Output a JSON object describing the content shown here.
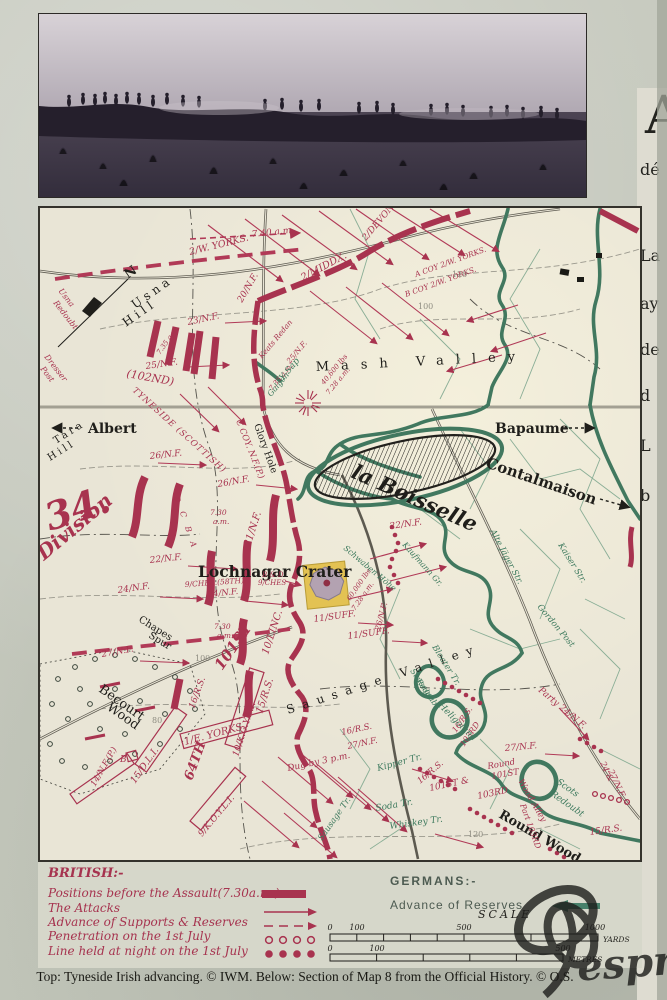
{
  "panel": {
    "caption": "Top: Tyneside Irish advancing. © IWM. Below: Section of Map 8 from the Official History. © O.S.",
    "watermark": "esprez"
  },
  "side_column": {
    "dropcap": "A",
    "line1": "dé",
    "line2": "La",
    "line3": "ay",
    "line4": "de",
    "line5": "d",
    "line6": "L",
    "line7": "b"
  },
  "colors": {
    "map_red": "#a8334f",
    "map_green": "#3e7a5e",
    "paper": "#e9e5d6",
    "panel": "#c6c9bf"
  },
  "map": {
    "labels": {
      "t740": "7.40 a.m.",
      "wyorks2": "2/W. YORKS.",
      "middx": "2/MIDDX.",
      "devon": "2/DEVON",
      "nf20": "20/N.F.",
      "acoy": "A COY 2/W. YORKS.",
      "bcoy": "B COY 2/W. YORKS.",
      "nf23": "23/N.F.",
      "nf25": "25/N.F.",
      "t735a": "7.35 a.m.",
      "d102": "(102ND)",
      "tyneside": "TYNESIDE (SCOTTISH)",
      "keats": "Keats Redan",
      "nf25b": "25/N.F.",
      "t735b": "7.35 a.m.",
      "mine1a": "40,600 lbs",
      "mine1b": "7.28 a.m.",
      "usna_redoubt1": "Usna",
      "usna_redoubt2": "Redoubt",
      "dresser1": "Dresser",
      "dresser2": "Post",
      "usna1": "Usna",
      "usna2": "Hill",
      "tara1": "Tara",
      "tara2": "Hill",
      "north": "N",
      "mash": "Mash Valley",
      "albert": "Albert",
      "bapaume": "Bapaume",
      "contalmaison": "Contalmaison",
      "la_boisselle": "la Boisselle",
      "glory": "Glory Hole",
      "ccoy": "C COY. N.F.(P.)",
      "div34": "34.",
      "division": "Division",
      "nf26a": "26/N.F.",
      "nf26b": "26/N.F.",
      "nf26c": "26/N.F.",
      "nf21": "21/N.F.",
      "compD": "D",
      "compC": "C",
      "compB": "B",
      "compA": "A",
      "t730a1": "7.30",
      "t730a2": "a.m.",
      "t730b1": "7.30",
      "t730b2": "a.m.",
      "nf22a": "22/N.F.",
      "nf22b": "22/N.F.",
      "nf24a": "24/N.F.",
      "nf24b": "24/N.F.",
      "ches9": "9/CHES.(58TH)",
      "bd1": "B & D",
      "bd2": "9/CHES",
      "lochnagar": "Lochnagar Crater",
      "suff11a": "11/SUFF.",
      "suff11b": "11/SUFF.",
      "mine2a": "60,000 lbs",
      "mine2b": "7.28 a.m.",
      "lincs": "10/LINC.",
      "st101": "101ST",
      "rs15a": "15/R.S.",
      "rs15b": "15/R.S.",
      "rs16a": "16/R.S.",
      "rs16b": "16/R.S.",
      "rs16c": "16/R.S.",
      "rs16d": "16/R.S.",
      "rd103a": "103RD",
      "st101amp": "101ST &",
      "rd103b": "103RD",
      "round1": "Round",
      "round2": "101ST",
      "part103": "Part 103RD",
      "woodalley": "Wood Alley",
      "party24": "Party 24/N.F.",
      "n2427a": "24 &",
      "n2427b": "27/N.F.",
      "nf27a": "27/N.F.",
      "nf27b": "27/N.F.",
      "nf27c": "27/N.F.",
      "eyorks": "1/E. YORKS.",
      "dli15": "15/D.L.I.",
      "bco": "B.",
      "nf14": "14/N.F.(P.)",
      "th64": "64TH",
      "koyli9": "9/K.O.Y.L.I.",
      "koyli10": "10/K.O.Y.L.I.",
      "dug3": "Dug by 3 p.m.",
      "sausage_valley": "Sausage Valley",
      "chapes1": "Chapes",
      "chapes2": "Spur",
      "becourt1": "Becourt",
      "becourt2": "Wood",
      "round_wood": "Round Wood",
      "ysap": "Y Sap",
      "galgen": "Galgen",
      "schwaben": "Schwaben Höhe",
      "kaufmann": "Kaufmann Gr.",
      "altejager": "Alte Jäger Str.",
      "kaiser": "Kaiser Str.",
      "gordon": "Gordon Post",
      "bloater": "Bloater Tr.",
      "sausred1": "Sausage",
      "sausred2": "Redoubt",
      "heligoland": "Heligoland",
      "kipper": "Kipper Tr.",
      "soda": "Soda Tr.",
      "whiskey": "Whiskey Tr.",
      "sausagetr": "Sausage Tr.",
      "scots1": "Scots",
      "scots2": "Redoubt",
      "c120a": "120",
      "c100a": "100",
      "c100b": "100",
      "c80": "80",
      "c120b": "120"
    }
  },
  "legend": {
    "british_title": "BRITISH:-",
    "items": [
      {
        "label": "Positions before the Assault(7.30a.m.)"
      },
      {
        "label": "The Attacks"
      },
      {
        "label": "Advance of Supports & Reserves"
      },
      {
        "label": "Penetration on the 1st July"
      },
      {
        "label": "Line held at night on the 1st July"
      }
    ],
    "germans_title": "GERMANS:-",
    "german_item": "Advance of Reserves",
    "scale_title": "SCALE",
    "yards": {
      "t0": "0",
      "t100": "100",
      "t500": "500",
      "t1000": "1000",
      "unit": "YARDS"
    },
    "metres": {
      "t0": "0",
      "t100": "100",
      "t500": "500",
      "unit": "METRES"
    }
  }
}
